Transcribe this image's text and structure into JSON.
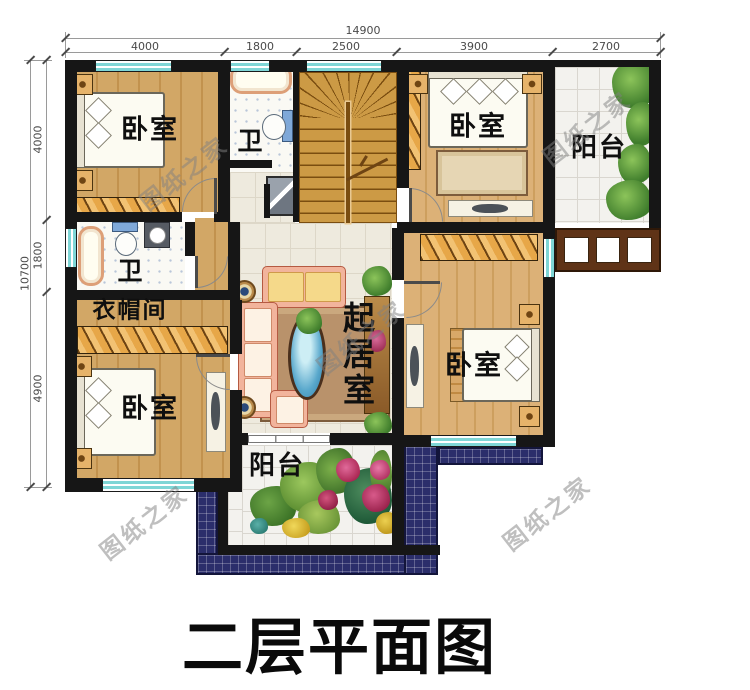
{
  "plan": {
    "title": "二层平面图",
    "watermark": "图纸之家"
  },
  "rooms": {
    "bedroom": "卧室",
    "bathroom": "卫",
    "cloakroom": "衣帽间",
    "living_room": "起居室",
    "balcony": "阳台"
  },
  "dims": {
    "top_total": "14900",
    "top_segments": [
      "4000",
      "1800",
      "2500",
      "3900",
      "2700"
    ],
    "left_total": "10700",
    "left_segments": [
      "4000",
      "1800",
      "4900"
    ]
  },
  "colors": {
    "wall": "#161616",
    "window_teal": "#7fd6d6",
    "wood_floor": "#d2a766",
    "light_tile_floor": "#eeeade",
    "wardrobe_hatch": "#f2c273",
    "roof_navy": "#2b2e6b",
    "railing_brown": "#5f3317",
    "sofa_salmon": "#f2b49c",
    "coffee_table_blue": "#59a8cc"
  }
}
